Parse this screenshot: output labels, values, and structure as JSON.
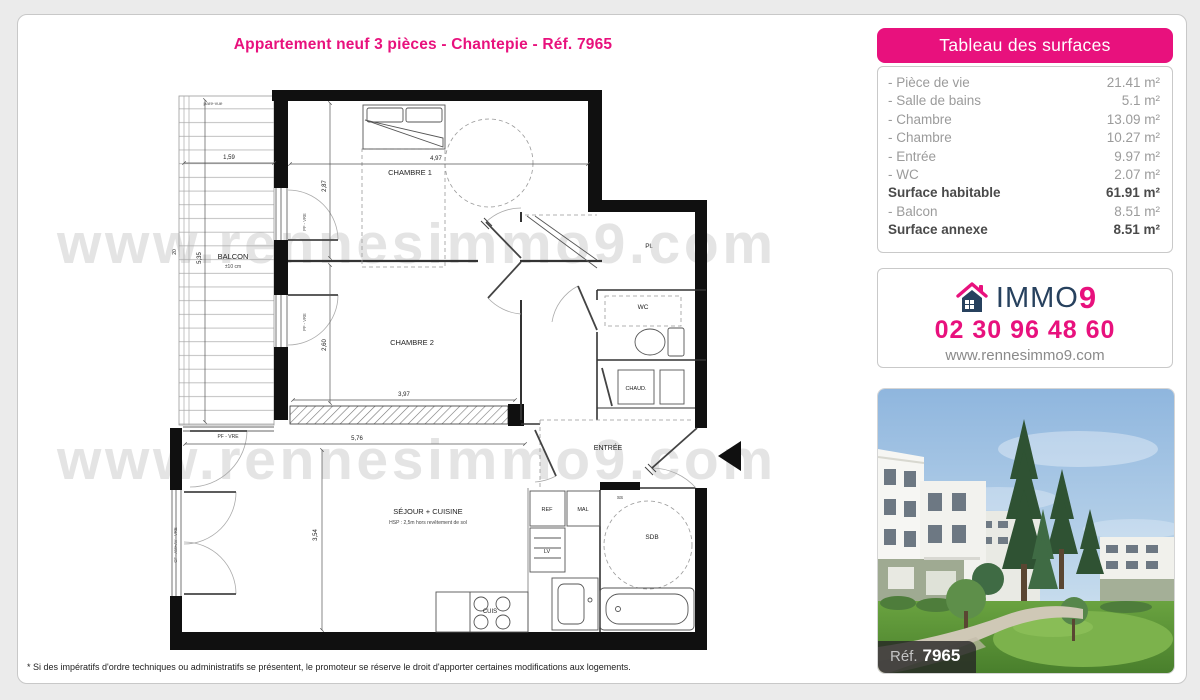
{
  "title": "Appartement neuf 3 pièces - Chantepie - Réf. 7965",
  "surfaces_panel": {
    "header": "Tableau des surfaces",
    "rows": [
      {
        "label": "- Pièce de vie",
        "value": "21.41 m²"
      },
      {
        "label": "- Salle de bains",
        "value": "5.1 m²"
      },
      {
        "label": "- Chambre",
        "value": "13.09 m²"
      },
      {
        "label": "- Chambre",
        "value": "10.27 m²"
      },
      {
        "label": "- Entrée",
        "value": "9.97 m²"
      },
      {
        "label": "- WC",
        "value": "2.07 m²"
      },
      {
        "label": "Surface habitable",
        "value": "61.91 m²"
      },
      {
        "label": "- Balcon",
        "value": "8.51 m²"
      },
      {
        "label": "Surface annexe",
        "value": "8.51 m²"
      }
    ]
  },
  "contact": {
    "brand_immo": "IMMO",
    "brand_nine": "9",
    "phone": "02 30 96 48 60",
    "website": "www.rennesimmo9.com"
  },
  "photo": {
    "ref_label": "Réf.",
    "ref_number": "7965"
  },
  "footer": {
    "disclaimer": "* Si des impératifs d'ordre techniques ou administratifs se présentent, le promoteur se réserve le droit d'apporter certaines modifications aux logements."
  },
  "plan": {
    "watermark": "www.rennesimmo9.com",
    "labels": {
      "chambre1": "CHAMBRE 1",
      "chambre2": "CHAMBRE 2",
      "sejour": "SÉJOUR + CUISINE",
      "sejour_note": "HSP : 2,5m hors revêtement de sol",
      "balcon": "BALCON",
      "balcon_note": "±10 cm",
      "entree": "ENTRÉE",
      "wc": "WC",
      "pl": "Pl.",
      "chaud": "CHAUD.",
      "sdb": "SDB",
      "ref_fridge": "REF",
      "mal": "MAL",
      "lv": "LV",
      "cuis": "CUIS",
      "ss": "SS",
      "pare_vue": "pare-vue",
      "pf_vre": "PF - VRE",
      "pf_vre_side": "PF - VRE",
      "cf_window": "CF - AM+AV - VRE"
    },
    "dims": {
      "balcon_w": "1,59",
      "balcon_h": "5,35",
      "balcon_d": "20",
      "ch1_w": "4,97",
      "ch1_h": "2,87",
      "ch2_h": "2,60",
      "ch2_w": "3,97",
      "sejour_w": "5,76",
      "sejour_h": "3,54"
    }
  },
  "colors": {
    "accent_pink": "#e8117d",
    "brand_navy": "#27415e",
    "page_bg": "#ebebeb"
  }
}
